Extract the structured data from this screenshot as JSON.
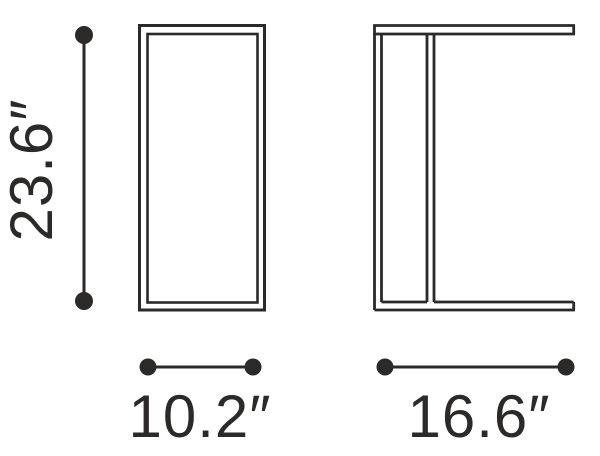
{
  "diagram": {
    "height_label": "23.6″",
    "width_label": "10.2″",
    "depth_label": "16.6″",
    "colors": {
      "line": "#2b2a29",
      "background": "#ffffff"
    }
  }
}
